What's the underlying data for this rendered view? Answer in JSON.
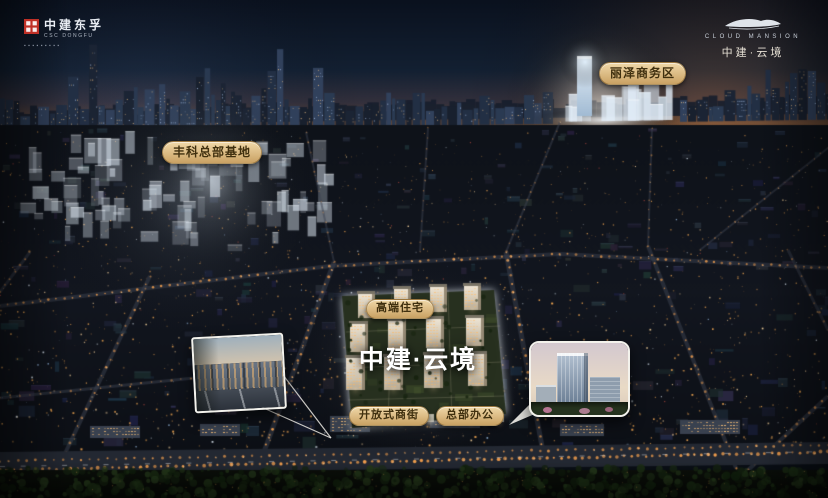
{
  "branding": {
    "top_left": {
      "seal_icon": "csc-dongfu-seal",
      "name_cn": "中建东孚",
      "name_en": "CSC DONGFU",
      "tagline_microtext": "▪▪▪▪▪▪▪▪▪"
    },
    "top_right": {
      "icon": "cloud-mansion-emblem",
      "name_en": "CLOUD MANSION",
      "name_cn": "中建·云境"
    }
  },
  "scene": {
    "project_title": "中建·云境",
    "district_labels": [
      {
        "id": "fengke",
        "text": "丰科总部基地"
      },
      {
        "id": "lize",
        "text": "丽泽商务区"
      }
    ],
    "site_labels": [
      {
        "id": "residence",
        "text": "高端住宅"
      },
      {
        "id": "open_street",
        "text": "开放式商街"
      },
      {
        "id": "hq_office",
        "text": "总部办公"
      }
    ],
    "insets": [
      {
        "id": "street-level-render",
        "icon": "photo-inset"
      },
      {
        "id": "office-tower-render",
        "icon": "photo-inset"
      }
    ],
    "colors": {
      "label_bg": "#dcb887",
      "label_text": "#40300f",
      "street_light": "#ffa64f",
      "sky_top": "#0a111e",
      "horizon_warm": "#6b4b35",
      "site_glow": "#e8f0fa"
    }
  }
}
